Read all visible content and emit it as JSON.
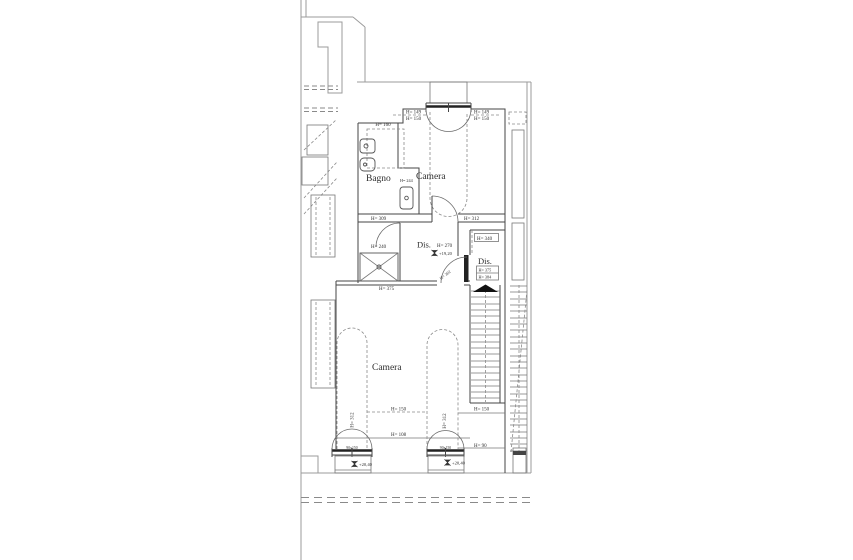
{
  "drawing": {
    "rooms": {
      "bagno": "Bagno",
      "camera_upper": "Camera",
      "camera_lower": "Camera",
      "dis_main": "Dis.",
      "dis_stairs": "Dis."
    },
    "heights": {
      "h160": "H= 160",
      "h149_left": "H= 149",
      "h150_left": "H= 150",
      "h149_right": "H= 149",
      "h150_right": "H= 150",
      "h244": "H= 244",
      "h309": "H= 309",
      "h312_upper": "H= 312",
      "h240": "H= 240",
      "h270": "H= 270",
      "h340": "H= 340",
      "h375_stairs": "H= 375",
      "h384": "H= 384",
      "h375_camera": "H= 375",
      "h302_door": "H= 302",
      "h312_lower_left": "H= 312",
      "h312_lower_mid": "H= 312",
      "h150_mid": "H= 150",
      "h108": "H= 108",
      "h150_right_low": "H= 150",
      "h90": "H= 90"
    },
    "elevations": {
      "dis": "+19,20",
      "balcony_left": "+20,40",
      "balcony_right": "+20,40"
    },
    "window_sizes": {
      "left": "90x150",
      "right": "90x150"
    },
    "colors": {
      "wall": "#454545",
      "light_line": "#9b9b9b",
      "text": "#2e2e2e",
      "background": "#ffffff"
    }
  }
}
